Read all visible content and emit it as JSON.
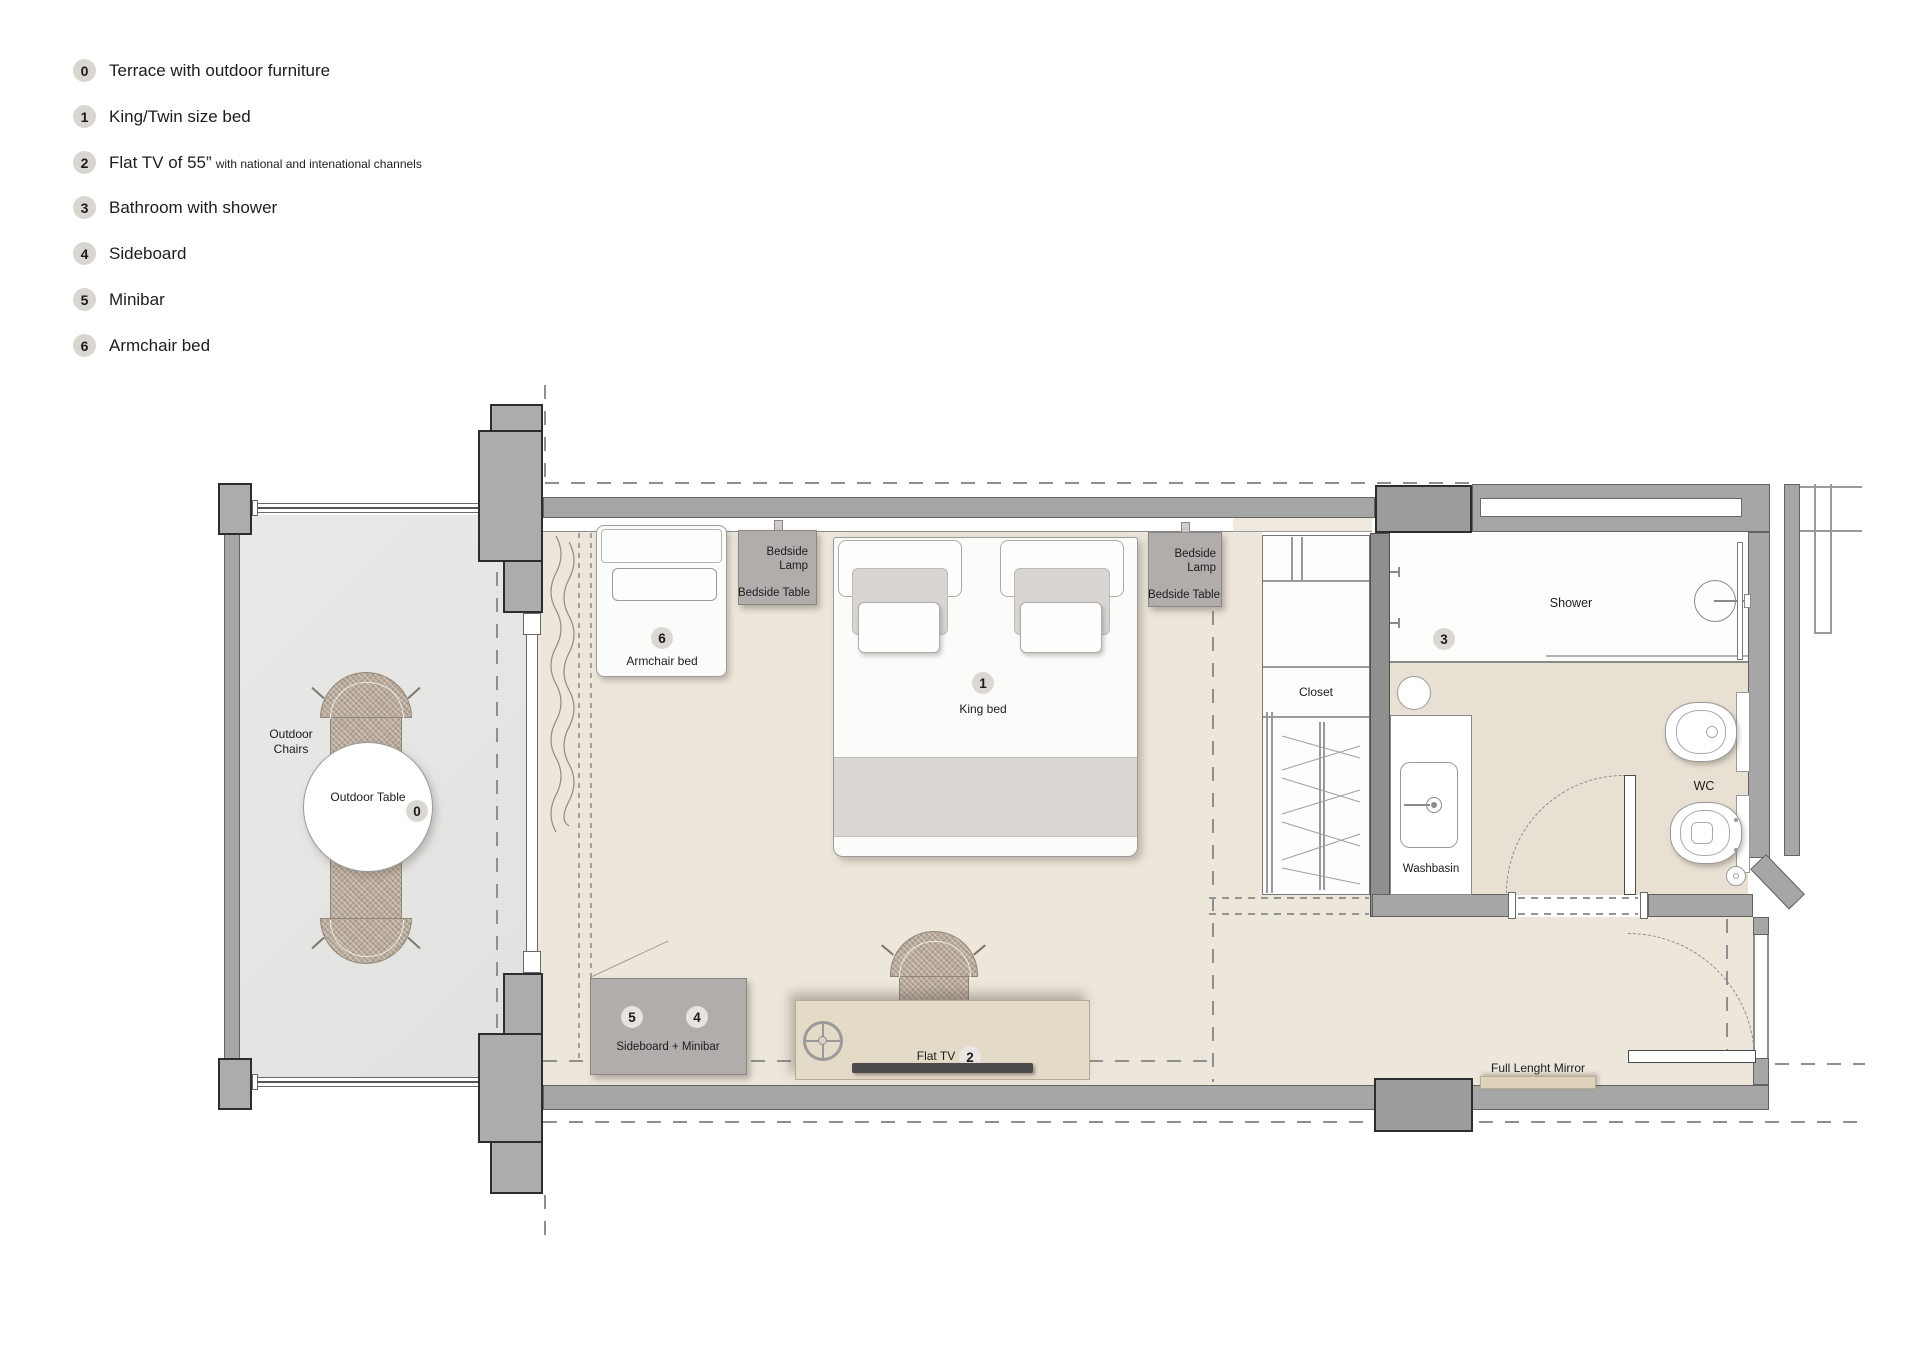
{
  "legend": {
    "items": [
      {
        "num": "0",
        "label": "Terrace with outdoor furniture",
        "suffix": ""
      },
      {
        "num": "1",
        "label": "King/Twin size bed",
        "suffix": ""
      },
      {
        "num": "2",
        "label": "Flat TV of 55”",
        "suffix": "with national and intenational channels"
      },
      {
        "num": "3",
        "label": "Bathroom with shower",
        "suffix": ""
      },
      {
        "num": "4",
        "label": "Sideboard",
        "suffix": ""
      },
      {
        "num": "5",
        "label": "Minibar",
        "suffix": ""
      },
      {
        "num": "6",
        "label": "Armchair bed",
        "suffix": ""
      }
    ]
  },
  "plan": {
    "terrace": {
      "chairs_label": "Outdoor Chairs",
      "table_label": "Outdoor Table",
      "table_badge": "0"
    },
    "bedroom": {
      "armchair_bed": {
        "badge": "6",
        "label": "Armchair bed"
      },
      "king_bed": {
        "badge": "1",
        "label": "King bed"
      },
      "bedside_left": {
        "lamp_label": "Bedside Lamp",
        "table_label": "Bedside Table"
      },
      "bedside_right": {
        "lamp_label": "Bedside Lamp",
        "table_label": "Bedside Table"
      },
      "sideboard": {
        "badge_minibar": "5",
        "badge_sideboard": "4",
        "label": "Sideboard + Minibar"
      },
      "tv": {
        "label": "Flat TV",
        "badge": "2"
      },
      "mirror": {
        "label": "Full Lenght Mirror"
      }
    },
    "closet": {
      "label": "Closet"
    },
    "bathroom": {
      "badge": "3",
      "shower_label": "Shower",
      "washbasin_label": "Washbasin",
      "wc_label": "WC"
    }
  },
  "colors": {
    "wall": "#a6a6a6",
    "column": "#acacac",
    "terrace_floor": "#e5e5e4",
    "bedroom_floor": "#ece6db",
    "bathroom_floor": "#e8e0d3",
    "furniture_gray": "#b1adaa",
    "desk": "#e4dac8",
    "tv_bar": "#4b4b4b",
    "mirror_bar": "#ded2ba",
    "badge_bg": "#dbd8d4"
  }
}
